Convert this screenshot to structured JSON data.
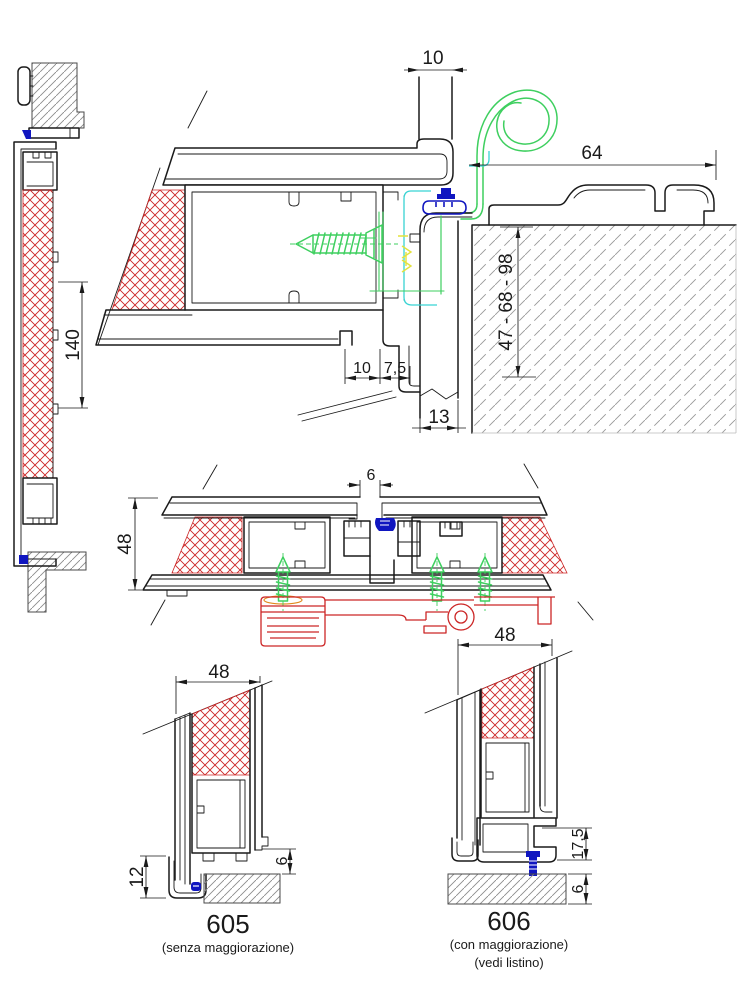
{
  "colors": {
    "ink": "#1a1a1a",
    "red": "#cc2626",
    "green": "#3ecf5f",
    "cyan": "#38d3d3",
    "yellow": "#e3e23c",
    "navy": "#1016c0",
    "hatch": "#8c8c8c",
    "hatchw": "#9a9a9a",
    "orange": "#e08a1e"
  },
  "drawing": {
    "left_section": {
      "frame_height": "140"
    },
    "corner_detail": {
      "slot_width_top": "10",
      "cover_width": "64",
      "wall_range": "47 - 68 - 98",
      "offset_a": "10",
      "offset_b": "7,5",
      "channel_width": "13"
    },
    "plan_section": {
      "interlock_gap": "6",
      "frame_depth": "48"
    },
    "variant_605": {
      "width": "48",
      "foot_height": "12",
      "floor_gap": "6",
      "code": "605",
      "note": "(senza maggiorazione)"
    },
    "variant_606": {
      "width": "48",
      "base_height": "17,5",
      "floor_gap": "6",
      "code": "606",
      "note_line1": "(con maggiorazione)",
      "note_line2": "(vedi listino)"
    }
  }
}
